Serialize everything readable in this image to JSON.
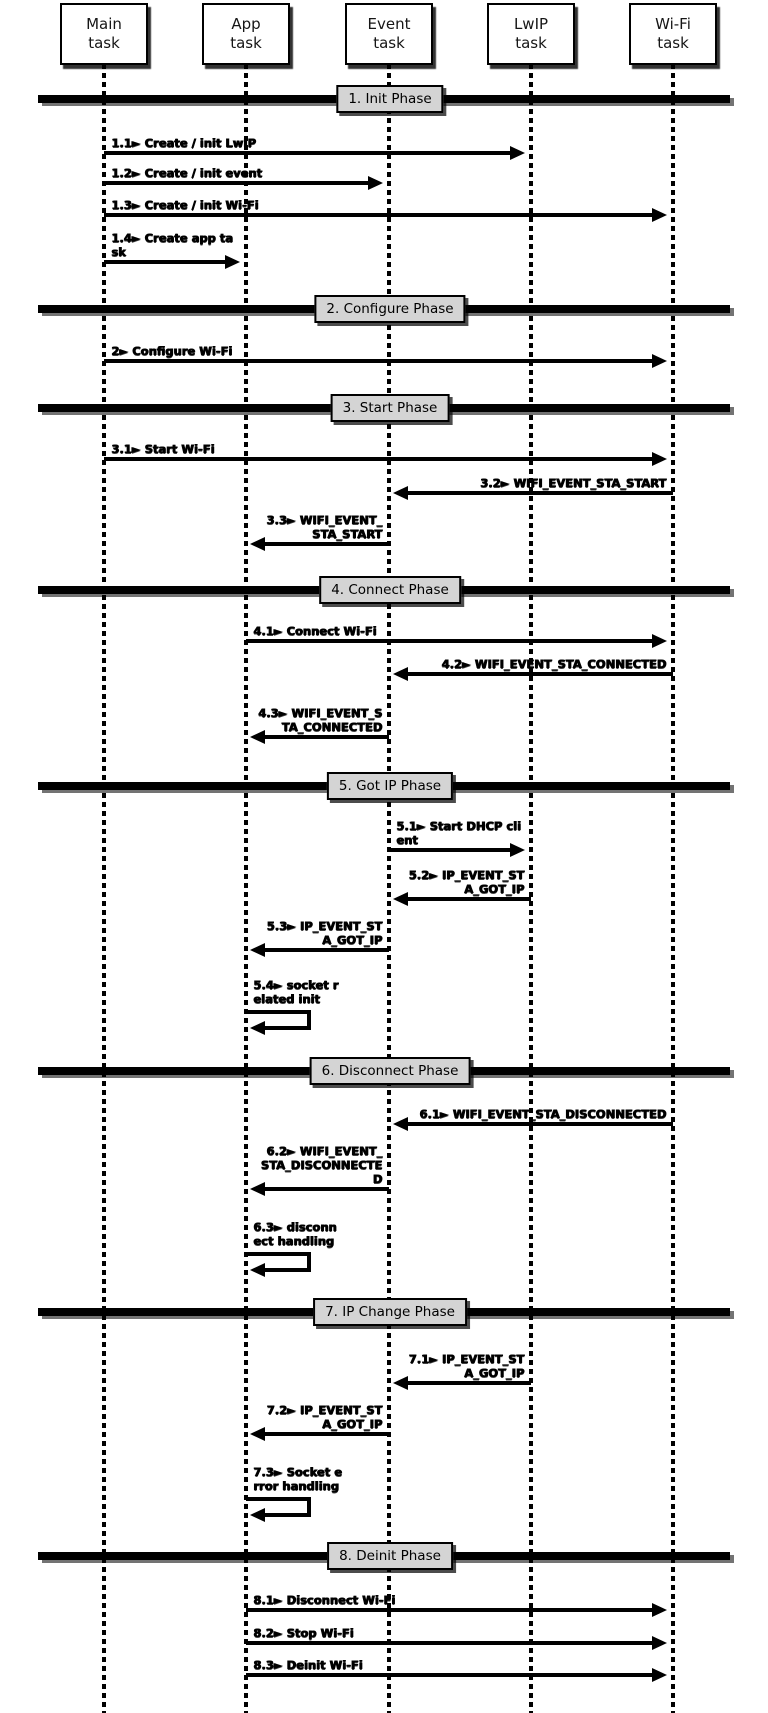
{
  "diagram": {
    "colors": {
      "ink": "#000000",
      "phase_box_bg": "#d4d4d4",
      "background": "#ffffff"
    },
    "actors": [
      {
        "id": "main",
        "lines": [
          "Main",
          "task"
        ]
      },
      {
        "id": "app",
        "lines": [
          "App",
          "task"
        ]
      },
      {
        "id": "event",
        "lines": [
          "Event",
          "task"
        ]
      },
      {
        "id": "lwip",
        "lines": [
          "LwIP",
          "task"
        ]
      },
      {
        "id": "wifi",
        "lines": [
          "Wi-Fi",
          "task"
        ]
      }
    ],
    "phases": [
      {
        "label": "1. Init Phase",
        "messages": [
          {
            "id": "1.1",
            "from": "main",
            "to": "lwip",
            "label_lines": [
              "1.1► Create / init LwIP"
            ]
          },
          {
            "id": "1.2",
            "from": "main",
            "to": "event",
            "label_lines": [
              "1.2► Create / init event"
            ]
          },
          {
            "id": "1.3",
            "from": "main",
            "to": "wifi",
            "label_lines": [
              "1.3► Create / init Wi-Fi"
            ]
          },
          {
            "id": "1.4",
            "from": "main",
            "to": "app",
            "label_lines": [
              "1.4► Create app ta",
              "sk"
            ]
          }
        ]
      },
      {
        "label": "2. Configure Phase",
        "messages": [
          {
            "id": "2",
            "from": "main",
            "to": "wifi",
            "label_lines": [
              "2► Configure Wi-Fi"
            ]
          }
        ]
      },
      {
        "label": "3. Start Phase",
        "messages": [
          {
            "id": "3.1",
            "from": "main",
            "to": "wifi",
            "label_lines": [
              "3.1► Start Wi-Fi"
            ]
          },
          {
            "id": "3.2",
            "from": "wifi",
            "to": "event",
            "label_lines": [
              "3.2► WIFI_EVENT_STA_START"
            ]
          },
          {
            "id": "3.3",
            "from": "event",
            "to": "app",
            "label_lines": [
              "3.3► WIFI_EVENT_",
              "STA_START"
            ]
          }
        ]
      },
      {
        "label": "4. Connect Phase",
        "messages": [
          {
            "id": "4.1",
            "from": "app",
            "to": "wifi",
            "label_lines": [
              "4.1► Connect Wi-Fi"
            ]
          },
          {
            "id": "4.2",
            "from": "wifi",
            "to": "event",
            "label_lines": [
              "4.2► WIFI_EVENT_STA_CONNECTED"
            ]
          },
          {
            "id": "4.3",
            "from": "event",
            "to": "app",
            "label_lines": [
              "4.3► WIFI_EVENT_S",
              "TA_CONNECTED"
            ]
          }
        ]
      },
      {
        "label": "5. Got IP Phase",
        "messages": [
          {
            "id": "5.1",
            "from": "event",
            "to": "lwip",
            "label_lines": [
              "5.1► Start DHCP cli",
              "ent"
            ]
          },
          {
            "id": "5.2",
            "from": "lwip",
            "to": "event",
            "label_lines": [
              "5.2► IP_EVENT_ST",
              "A_GOT_IP"
            ]
          },
          {
            "id": "5.3",
            "from": "event",
            "to": "app",
            "label_lines": [
              "5.3► IP_EVENT_ST",
              "A_GOT_IP"
            ]
          },
          {
            "id": "5.4",
            "from": "app",
            "to": "app",
            "label_lines": [
              "5.4► socket r",
              "elated init"
            ]
          }
        ]
      },
      {
        "label": "6. Disconnect Phase",
        "messages": [
          {
            "id": "6.1",
            "from": "wifi",
            "to": "event",
            "label_lines": [
              "6.1► WIFI_EVENT_STA_DISCONNECTED"
            ]
          },
          {
            "id": "6.2",
            "from": "event",
            "to": "app",
            "label_lines": [
              "6.2► WIFI_EVENT_",
              "STA_DISCONNECTE",
              "D"
            ]
          },
          {
            "id": "6.3",
            "from": "app",
            "to": "app",
            "label_lines": [
              "6.3► disconn",
              "ect handling"
            ]
          }
        ]
      },
      {
        "label": "7. IP Change Phase",
        "messages": [
          {
            "id": "7.1",
            "from": "lwip",
            "to": "event",
            "label_lines": [
              "7.1► IP_EVENT_ST",
              "A_GOT_IP"
            ]
          },
          {
            "id": "7.2",
            "from": "event",
            "to": "app",
            "label_lines": [
              "7.2► IP_EVENT_ST",
              "A_GOT_IP"
            ]
          },
          {
            "id": "7.3",
            "from": "app",
            "to": "app",
            "label_lines": [
              "7.3► Socket e",
              "rror handling"
            ]
          }
        ]
      },
      {
        "label": "8. Deinit Phase",
        "messages": [
          {
            "id": "8.1",
            "from": "app",
            "to": "wifi",
            "label_lines": [
              "8.1► Disconnect Wi-Fi"
            ]
          },
          {
            "id": "8.2",
            "from": "app",
            "to": "wifi",
            "label_lines": [
              "8.2► Stop Wi-Fi"
            ]
          },
          {
            "id": "8.3",
            "from": "app",
            "to": "wifi",
            "label_lines": [
              "8.3► Deinit Wi-Fi"
            ]
          }
        ]
      }
    ]
  }
}
